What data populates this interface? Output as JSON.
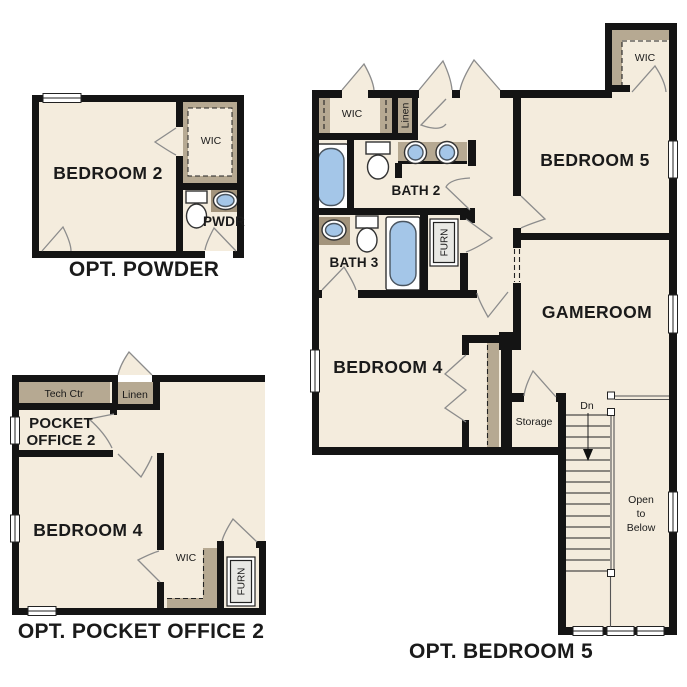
{
  "colors": {
    "background": "#ffffff",
    "floor": "#f4ecdd",
    "tan": "#b6a992",
    "counter": "#a3947c",
    "fixture_blue": "#a4c6e8",
    "wall": "#141414",
    "door": "#8c8c8c"
  },
  "plans": {
    "powder": {
      "caption": "OPT. POWDER",
      "labels": {
        "bedroom2": "BEDROOM 2",
        "wic": "WIC",
        "pwdr": "PWDR"
      }
    },
    "pocket_office2": {
      "caption": "OPT. POCKET OFFICE 2",
      "labels": {
        "tech_ctr": "Tech Ctr",
        "linen": "Linen",
        "pocket_line1": "POCKET",
        "pocket_line2": "OFFICE 2",
        "bedroom4": "BEDROOM 4",
        "wic": "WIC",
        "furn": "FURN"
      }
    },
    "bedroom5": {
      "caption": "OPT. BEDROOM 5",
      "labels": {
        "wic_hall": "WIC",
        "linen": "Linen",
        "bath2": "BATH 2",
        "bedroom5": "BEDROOM 5",
        "wic_bed5": "WIC",
        "bath3": "BATH 3",
        "furn": "FURN",
        "gameroom": "GAMEROOM",
        "bedroom4": "BEDROOM 4",
        "storage": "Storage",
        "down": "Dn",
        "open_below_line1": "Open",
        "open_below_line2": "to",
        "open_below_line3": "Below"
      }
    }
  }
}
